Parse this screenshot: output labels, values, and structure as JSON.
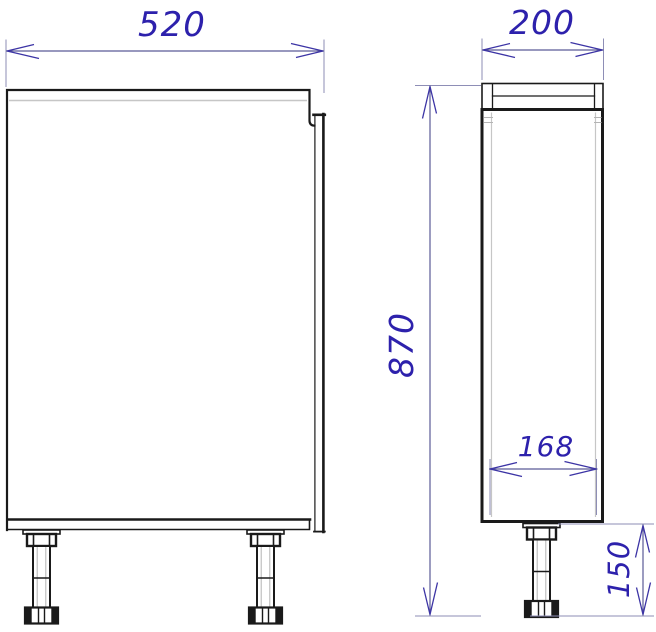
{
  "drawing": {
    "type": "cabinet-technical-drawing",
    "views": {
      "front": {
        "name": "front-view"
      },
      "side": {
        "name": "side-view"
      }
    },
    "dimensions": {
      "width": "520",
      "depth": "200",
      "height": "870",
      "inner_depth": "168",
      "leg_height": "150"
    },
    "colors": {
      "outline": "#1a1a1a",
      "light_line": "#c6c6c6",
      "dimension_line": "#5a5a96",
      "extension_line": "#8e8eb6",
      "arrow": "#3c34a5",
      "dimension_text": "#2d21ac",
      "background": "#ffffff"
    }
  }
}
